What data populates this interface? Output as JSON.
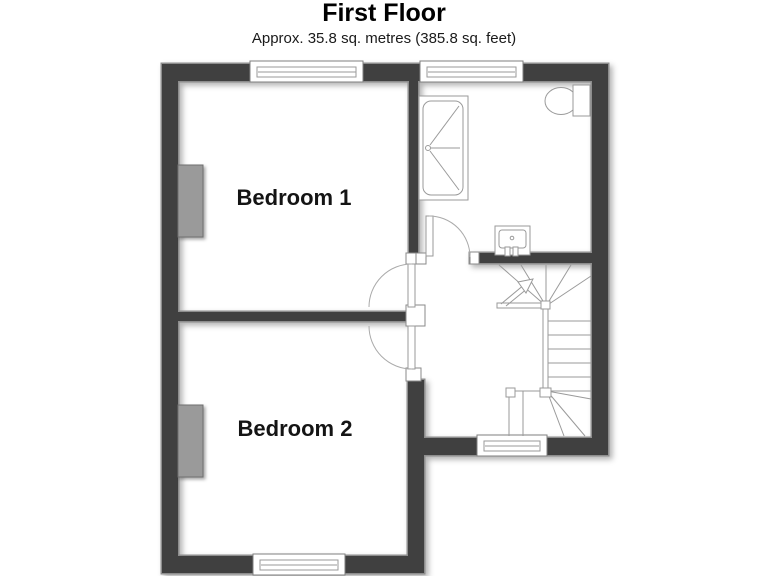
{
  "title": "First Floor",
  "subtitle": "Approx. 35.8 sq. metres (385.8 sq. feet)",
  "rooms": {
    "bedroom1": {
      "label": "Bedroom 1"
    },
    "bedroom2": {
      "label": "Bedroom 2"
    }
  },
  "symbols": [
    "window",
    "door-swing",
    "bath-shower",
    "toilet",
    "wash-basin",
    "staircase-winder",
    "up-arrow",
    "chimney-breast"
  ],
  "colors": {
    "wall": "#3f3f3f",
    "wall_outline": "#8d8d8d",
    "chimney": "#9a9a9a",
    "fixture_line": "#9a9a9a",
    "label_text": "#141414",
    "background": "#ffffff"
  }
}
